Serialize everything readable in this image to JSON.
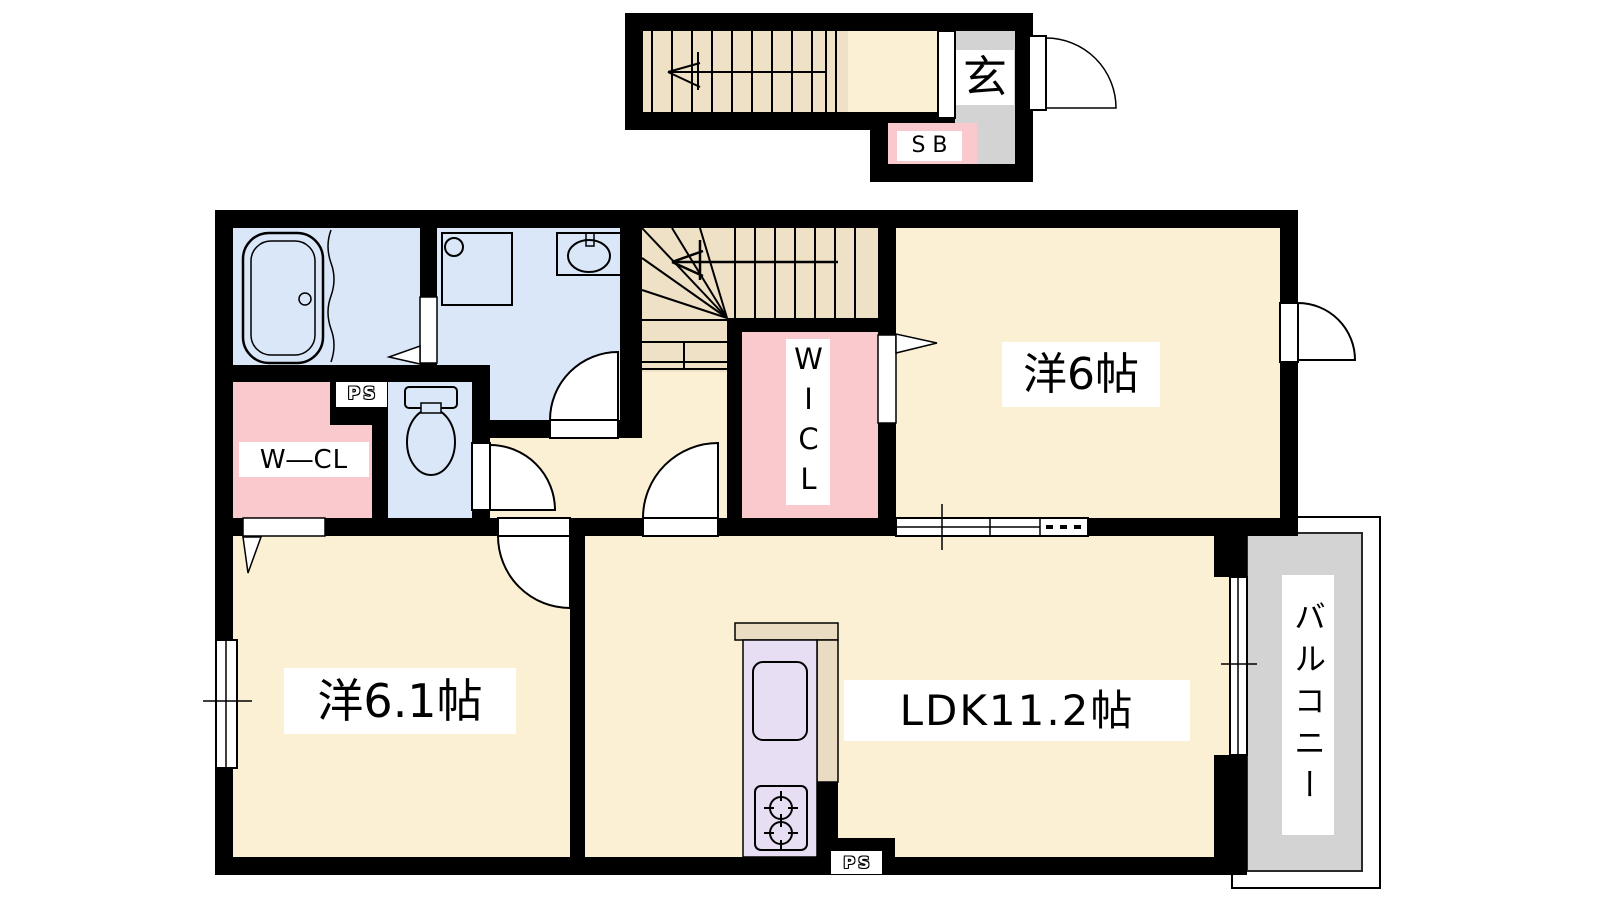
{
  "title": "apartment-floor-plan",
  "rooms": [
    {
      "id": "genkan",
      "label": "玄",
      "type": "entrance"
    },
    {
      "id": "shoe_box",
      "label": "SB",
      "type": "shoe-box"
    },
    {
      "id": "pipe_space_upper",
      "label": "PS",
      "type": "pipe-space"
    },
    {
      "id": "w_cl",
      "label": "W―CL",
      "type": "walk-in-closet"
    },
    {
      "id": "wicl",
      "label": "WICL",
      "type": "walk-in-closet"
    },
    {
      "id": "western_room_6",
      "label": "洋6帖",
      "type": "western-room"
    },
    {
      "id": "western_room_6_1",
      "label": "洋6.1帖",
      "type": "western-room"
    },
    {
      "id": "ldk",
      "label": "LDK11.2帖",
      "type": "living-dining-kitchen"
    },
    {
      "id": "balcony",
      "label": "バルコニー",
      "type": "balcony"
    },
    {
      "id": "pipe_space_lower",
      "label": "PS",
      "type": "pipe-space"
    }
  ],
  "unlabeled_areas": [
    "bathroom",
    "washroom",
    "toilet",
    "staircase-upper",
    "staircase-main",
    "hallway",
    "kitchen"
  ],
  "icons": {
    "bathtub": "double-rounded-rect with drain circle",
    "washing_machine_pan": "square with corner circle",
    "wash_basin": "oval in rect with faucet stub",
    "toilet": "tank rect with bowl ellipse",
    "kitchen_sink": "rounded rect",
    "gas_stove": "two burner circles with ticks",
    "stair_direction_arrow": "line with open arrowhead",
    "door_swing": "quarter-circle arc with leaf",
    "sliding_window": "white band with center line and tick",
    "open_doorway": "white gap with triangle marker"
  },
  "colors": {
    "wall": "#000000",
    "floor_cream": "#fcf0d4",
    "wet_area_blue": "#d9e7f8",
    "closet_pink": "#fac9ce",
    "stairs_tan": "#efe1c6",
    "kitchen_lavender": "#e7def3",
    "counter_tan": "#e9dcc3",
    "tile_gray": "#d3d3d3",
    "label_bg": "#ffffff"
  }
}
